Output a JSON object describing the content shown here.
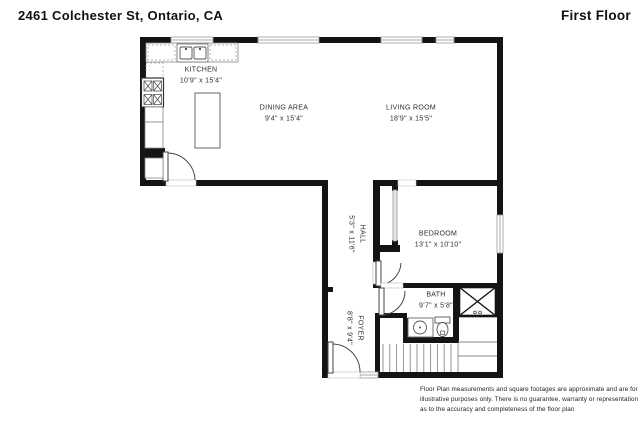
{
  "header": {
    "address": "2461 Colchester St, Ontario, CA",
    "floor_label": "First Floor"
  },
  "rooms": [
    {
      "id": "kitchen",
      "name": "KITCHEN",
      "dims": "10'9\" x 15'4\""
    },
    {
      "id": "dining",
      "name": "DINING AREA",
      "dims": "9'4\" x 15'4\""
    },
    {
      "id": "living",
      "name": "LIVING ROOM",
      "dims": "18'9\" x 15'5\""
    },
    {
      "id": "bedroom",
      "name": "BEDROOM",
      "dims": "13'1\" x 10'10\""
    },
    {
      "id": "bath",
      "name": "BATH",
      "dims": "9'7\" x 5'8\""
    },
    {
      "id": "hall",
      "name": "HALL",
      "dims": "5'3\" x 11'6\""
    },
    {
      "id": "foyer",
      "name": "FOYER",
      "dims": "8'8\" x 9'4\""
    }
  ],
  "fixtures": [
    "kitchen-sink",
    "stove-range",
    "kitchen-island",
    "counters",
    "bedroom-closet-sliding-door",
    "bathroom-vanity-sink",
    "toilet",
    "stairs",
    "x-marked-storage",
    "entry-door",
    "windows"
  ],
  "colors": {
    "wall": "#141414",
    "fixture_outline": "#666666",
    "window_gray": "#aaaaaa"
  },
  "disclaimer": "Floor Plan measurements and square footages are approximate and are for illustrative purposes only. There is no guarantee, warranty or representation as to the accuracy and completeness of the floor plan"
}
